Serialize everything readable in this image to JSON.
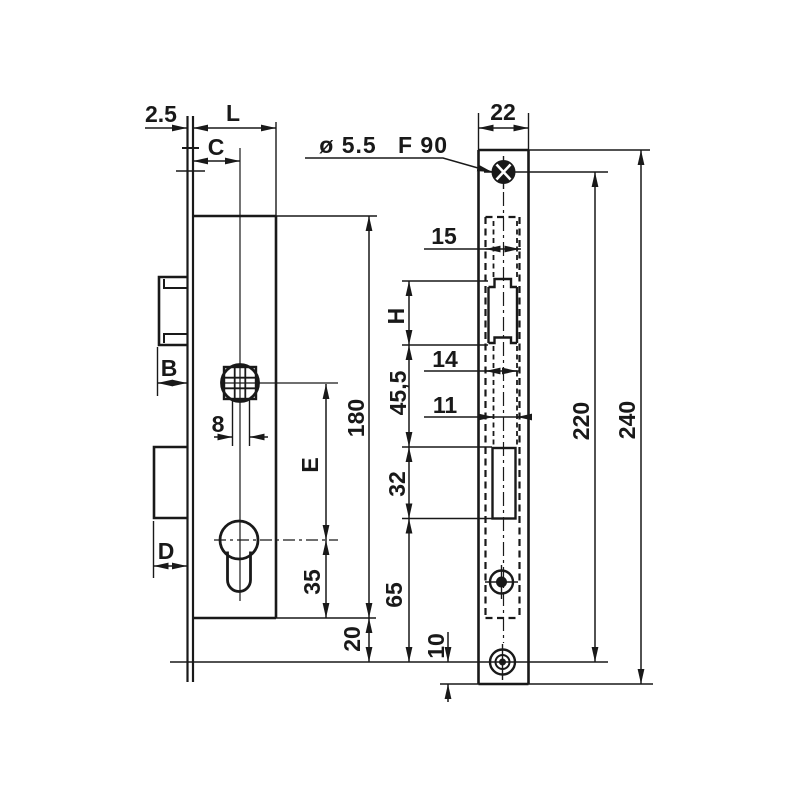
{
  "meta": {
    "drawing_type": "mortise-lock-dimension-drawing",
    "ink_color": "#191919",
    "paper_color": "#ffffff"
  },
  "annotations": {
    "hole_note_diameter": "ø 5.5",
    "hole_note_code": "F 90"
  },
  "dimensions": {
    "plate_thickness": "2.5",
    "case_depth": "L",
    "backset": "C",
    "faceplate_width": "22",
    "case_width": "15",
    "latch_opening_height": "H",
    "latch_face_width": "14",
    "latch_to_bolt_distance": "45,5",
    "opening_width": "11",
    "screw_spacing": "220",
    "faceplate_height": "240",
    "case_height": "180",
    "spindle_square": "8",
    "latch_projection": "B",
    "centre_distance": "E",
    "bolt_opening_height": "32",
    "bolt_projection": "D",
    "cylinder_to_case_bottom": "35",
    "bolt_to_plate_end": "65",
    "case_to_plate_end": "20",
    "screw_edge_offset": "10"
  }
}
